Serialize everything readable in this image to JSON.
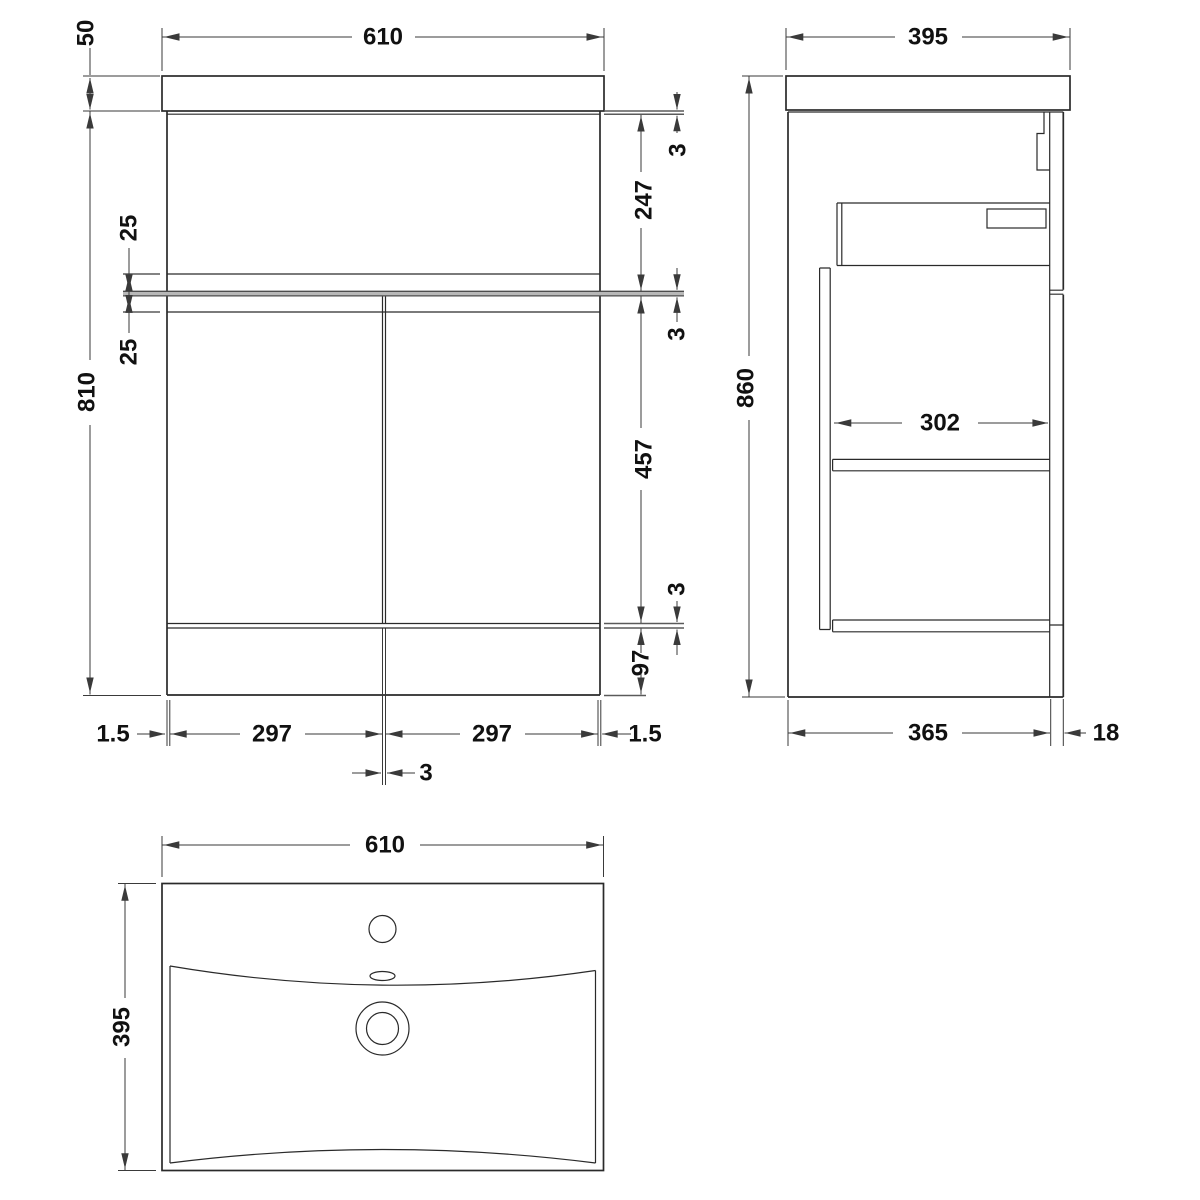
{
  "front_view": {
    "width": "610",
    "basin_height": "50",
    "total_height": "810",
    "gap_upper_25": "25",
    "gap_lower_25": "25",
    "gap_top_3": "3",
    "panel_height_247": "247",
    "gap_mid_3": "3",
    "door_height_457": "457",
    "gap_bottom_3": "3",
    "plinth_height_97": "97",
    "edge_gap_left": "1.5",
    "door_width_left": "297",
    "center_gap_3": "3",
    "door_width_right": "297",
    "edge_gap_right": "1.5"
  },
  "side_view": {
    "depth": "395",
    "total_height": "860",
    "internal_depth_302": "302",
    "body_depth_365": "365",
    "back_panel_18": "18"
  },
  "top_view": {
    "width": "610",
    "depth": "395"
  },
  "palette": {
    "line": "#2a2a2a",
    "dim": "#3a3a3a",
    "thick": "#5a5a5a",
    "band": "#b8b8b8",
    "band-edge": "#4d4d4d",
    "text": "#111111",
    "bg": "#ffffff"
  }
}
